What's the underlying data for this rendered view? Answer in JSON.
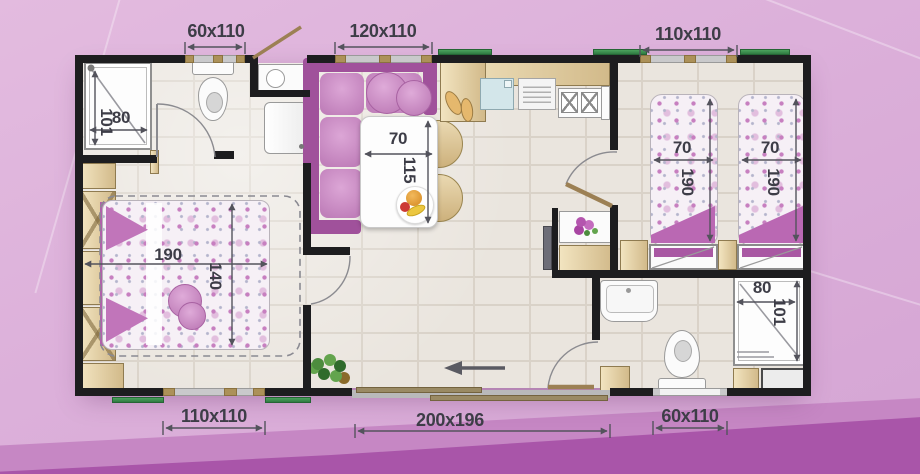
{
  "plan": {
    "type": "mobile-home floor plan",
    "exterior_dimensions": {
      "top": [
        "60x110",
        "120x110",
        "110x110"
      ],
      "bottom": [
        "110x110",
        "200x196",
        "60x110"
      ]
    },
    "interior_dimensions": {
      "shower_main": {
        "width": "80",
        "depth": "101"
      },
      "dining_table": {
        "width": "70",
        "length": "115"
      },
      "master_bed": {
        "length": "190",
        "width": "140"
      },
      "twin_bed_left": {
        "width": "70",
        "length": "190"
      },
      "twin_bed_right": {
        "width": "70",
        "length": "190"
      },
      "shower_second": {
        "width": "80",
        "depth": "101"
      }
    },
    "colors": {
      "background": "#dcb0da",
      "background_band": "#c687c4",
      "background_band_dark": "#a955a9",
      "wall": "#1d1d1f",
      "floor": "#eae5de",
      "accent_purple": "#a0519b",
      "furniture_beige": "#e3cfa2",
      "awning_green": "#3f9150",
      "dimension_text": "#3d3d47"
    }
  }
}
